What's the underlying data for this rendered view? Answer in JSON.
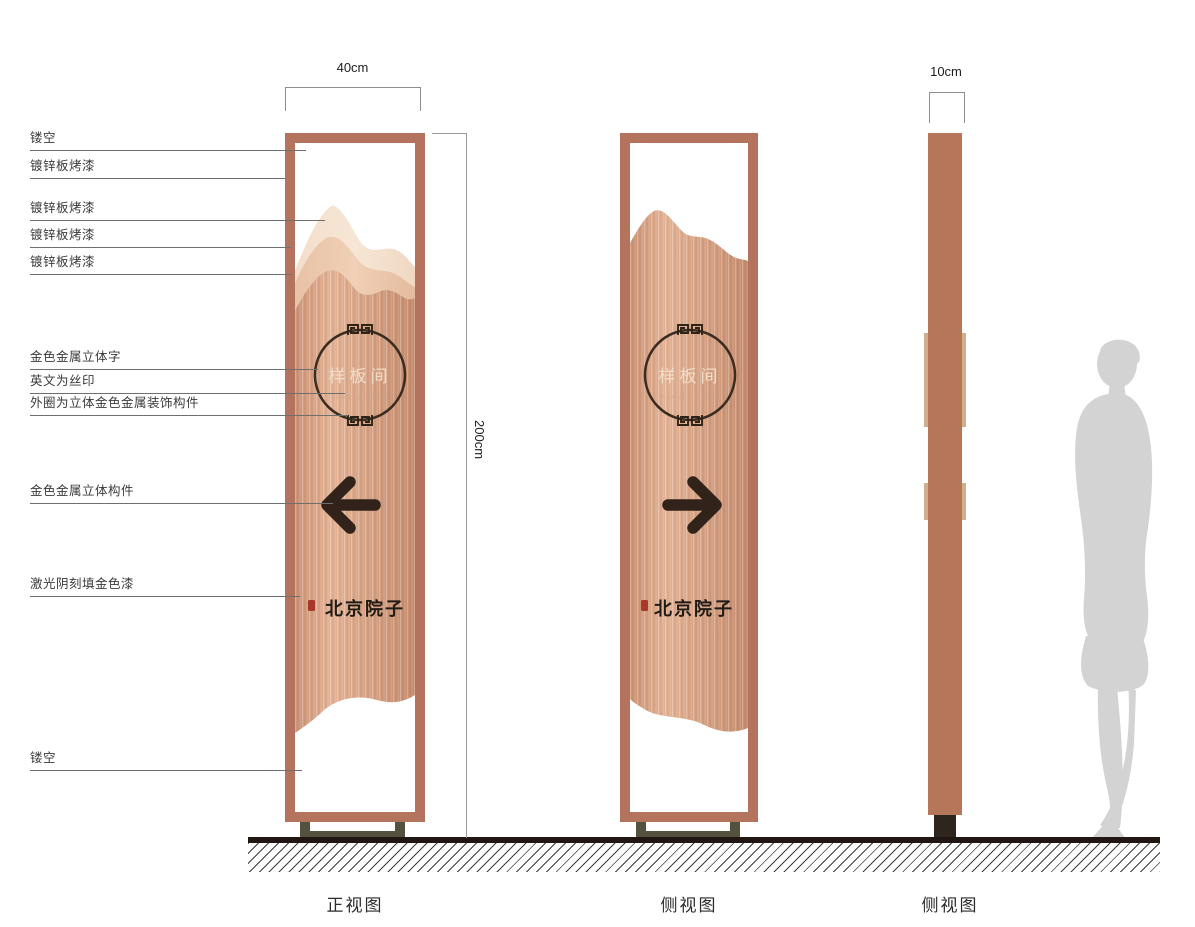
{
  "captions": {
    "front": "正视图",
    "side": "侧视图",
    "profile": "侧视图"
  },
  "dimensions": {
    "front_width": "40cm",
    "height": "200cm",
    "profile_width": "10cm"
  },
  "panel": {
    "room_name": "样板间",
    "room_name_en": "SAMPLE ROOM",
    "brand": "北京院子"
  },
  "annotations": [
    "镂空",
    "镀锌板烤漆",
    "镀锌板烤漆",
    "镀锌板烤漆",
    "镀锌板烤漆",
    "金色金属立体字",
    "英文为丝印",
    "外圈为立体金色金属装饰构件",
    "金色金属立体构件",
    "激光阴刻填金色漆",
    "镂空"
  ],
  "colors": {
    "frame_copper": "#b3735c",
    "body_copper_light": "#e3b294",
    "body_copper_dark": "#c88d6f",
    "mountain_back": "#f3decb",
    "mountain_mid": "#ecc5a8",
    "graphic_dark": "#31221a",
    "base_olive": "#54523e",
    "foot_dark": "#2e251d",
    "seal_red": "#a8392a",
    "silhouette_gray": "#d3d3d3"
  }
}
